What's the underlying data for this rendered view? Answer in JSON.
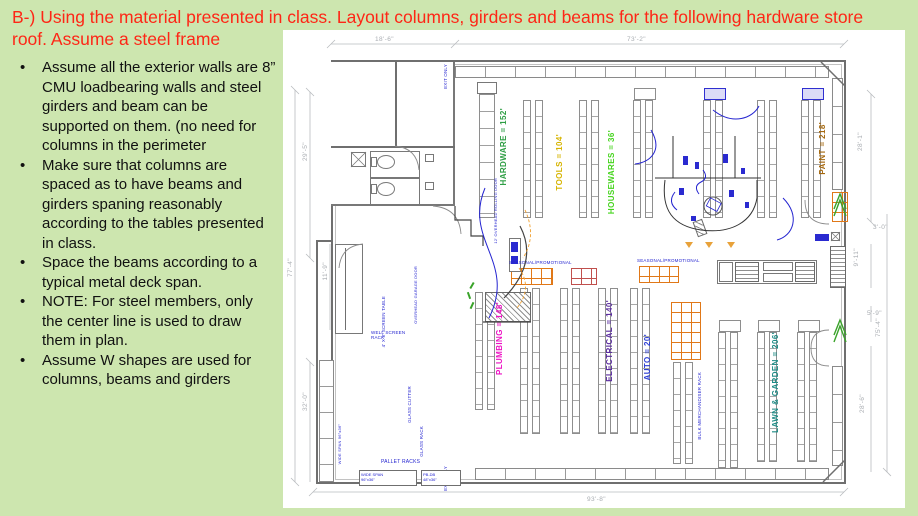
{
  "slide": {
    "background": "#cde6af",
    "title": "B-) Using the material presented in class. Layout columns, girders and beams for the following hardware store roof. Assume a steel frame",
    "title_color": "#fe2616",
    "bullets": [
      "Assume all the exterior walls are 8” CMU loadbearing walls and steel girders and beam can be supported on them. (no need for columns in the perimeter",
      "Make sure that columns are spaced as to have beams and girders spaning reasonably according to the tables presented in class.",
      "Space the beams according to a typical metal deck span.",
      "NOTE: For steel members, only the center line is used to draw them in plan.",
      "Assume W shapes are used for columns, beams and girders"
    ]
  },
  "plan": {
    "departments": {
      "hardware": {
        "label": "HARDWARE = 152'",
        "color": "#2e9e44"
      },
      "tools": {
        "label": "TOOLS = 104'",
        "color": "#d6b400"
      },
      "housewares": {
        "label": "HOUSEWARES = 36'",
        "color": "#46d41e"
      },
      "paint": {
        "label": "PAINT = 218'",
        "color": "#a5680f"
      },
      "plumbing": {
        "label": "PLUMBING = 148'",
        "color": "#ee12c4"
      },
      "electrical": {
        "label": "ELECTRICAL = 140'",
        "color": "#5b2da0"
      },
      "auto": {
        "label": "AUTO = 20'",
        "color": "#2d3fd4"
      },
      "lawn": {
        "label": "LAWN & GARDEN = 206'",
        "color": "#1f8c86"
      }
    },
    "dims": {
      "top_left": "18'-6\"",
      "top_right": "73'-2\"",
      "left_upper": "29'-5\"",
      "left_outer": "77'-4\"",
      "left_inner": "11'-9\"",
      "left_lower": "32'-0\"",
      "bottom": "93'-8\"",
      "right_upper": "28'-1\"",
      "right_door_upper": "3'-0\"",
      "right_mid_inner": "9'-11\"",
      "right_outer": "75'-4\"",
      "right_door_lower": "5'-9\"",
      "right_lower": "28'-6\""
    },
    "ann": {
      "exit_only_top": "EXIT ONLY",
      "exit_only_bottom": "EXIT ONLY",
      "overhead_door": "12' OVERHEAD ROLLING DOOR",
      "garage_door": "OVERHEAD GARAGE DOOR",
      "seasonal_left": "SEASONAL/PROMOTIONAL",
      "seasonal_right": "SEASONAL/PROMOTIONAL",
      "screen_table": "4' X 8' SCREEN TABLE",
      "well_screen_rack": "WELL SCREEN RACK",
      "glass_cutter": "GLASS CUTTER",
      "glass_rack": "GLASS RACK",
      "pallet_racks": "PALLET RACKS",
      "wide_span_box": "WIDE SPAN\n96\"x36\"",
      "pbdb_box": "PB-DB\n48\"x36\"",
      "wide_span_left": "WIDE SPAN 96\"x36\"",
      "bulk_rack": "BULK MERCHANDISER RACK"
    },
    "colors": {
      "linework": "#6f6f6f",
      "dimension": "#a9adb2",
      "annotation_blue": "#2424d0",
      "pallet_orange": "#e07818",
      "seasonal_red": "#c0504d",
      "door_green": "#3aa32a"
    }
  }
}
